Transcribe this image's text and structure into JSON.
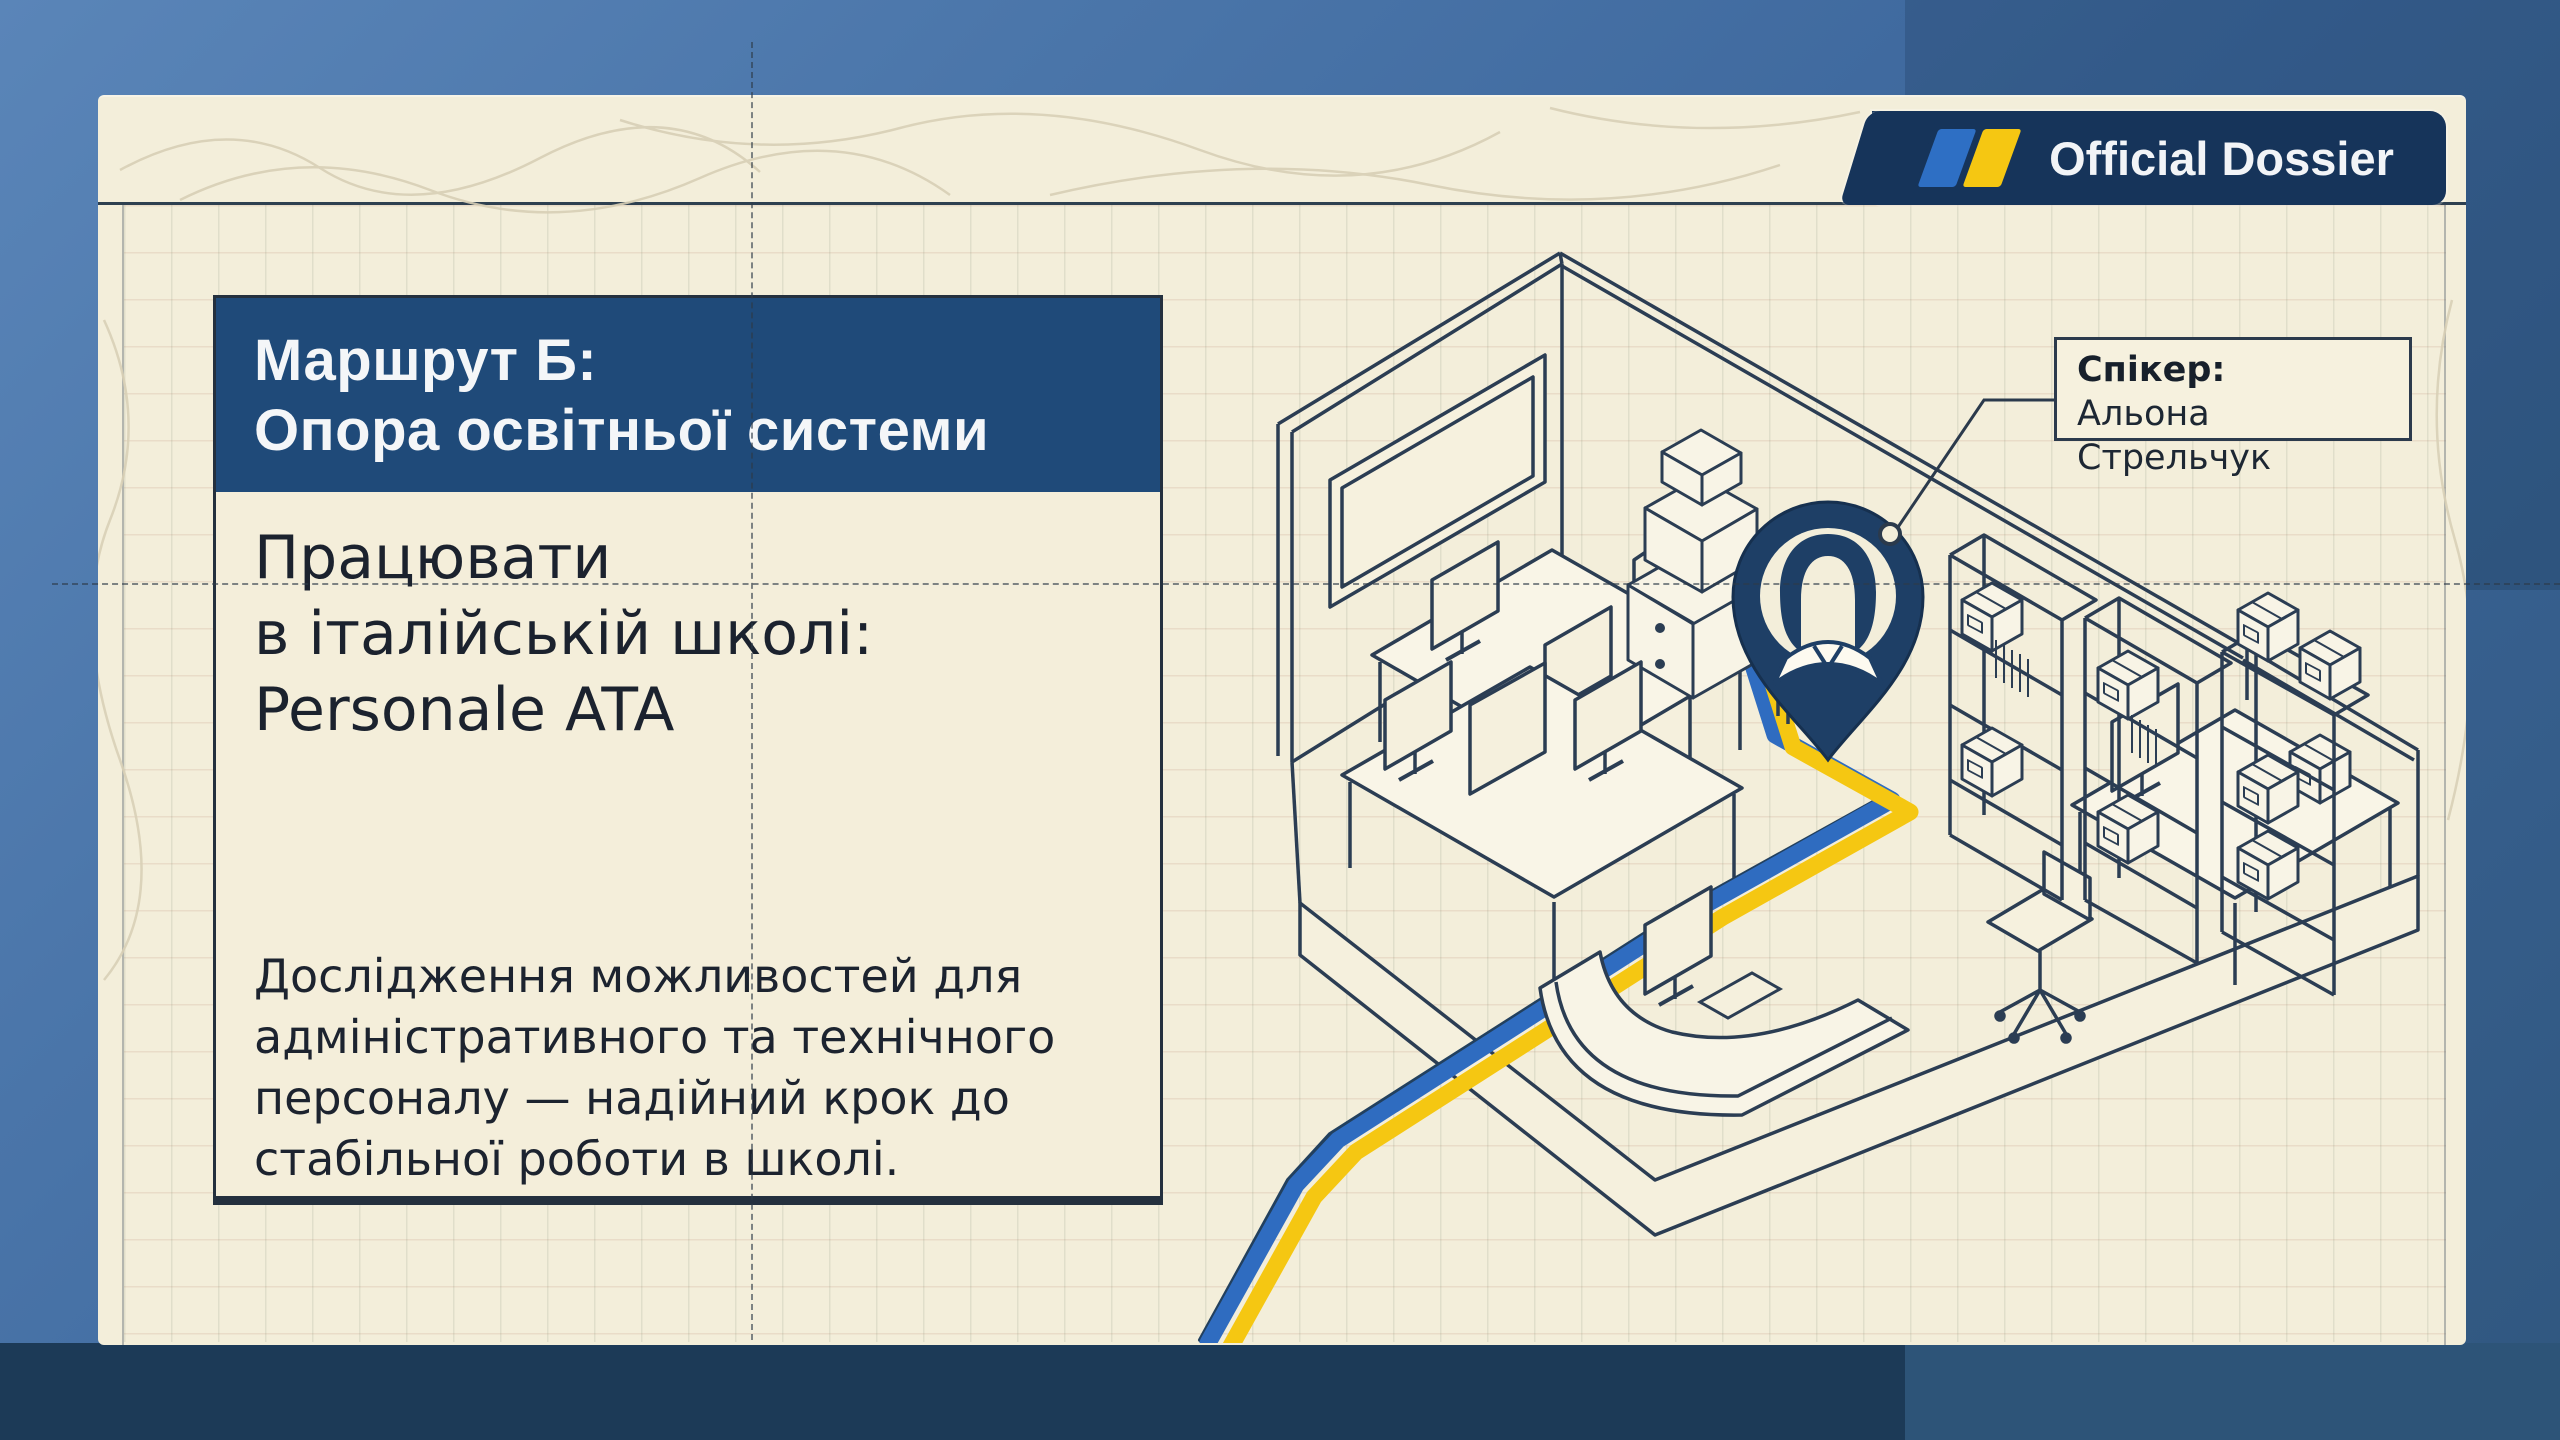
{
  "badge": {
    "label": "Official Dossier",
    "flag_icon": "ukraine-flag-stripes",
    "background": "#16345a",
    "stripe_blue": "#2e6fc4",
    "stripe_yellow": "#f5c712"
  },
  "panel": {
    "title": {
      "line1": "Маршрут Б:",
      "line2": "Опора освітньої системи",
      "background": "#1f4a79"
    },
    "subtitle": {
      "line1": "Працювати",
      "line2": "в італійській школі:",
      "line3": "Personale ATA"
    },
    "body": {
      "line1": "Дослідження можливостей для",
      "line2": "адміністративного та технічного",
      "line3": "персоналу — надійний крок до",
      "line4": "стабільної роботи в школі."
    }
  },
  "callout": {
    "label": "Спікер:",
    "name": "Альона Стрельчук"
  },
  "illustration": {
    "type": "isometric-office-room",
    "elements": [
      "left-wall-whiteboard",
      "open-door",
      "desks-with-monitors",
      "printer-stack",
      "storage-racks-with-boxes",
      "reception-counter",
      "office-chair",
      "location-pin-with-person",
      "blue-yellow-route"
    ],
    "route_blue": "#2f6cc0",
    "route_yellow": "#f5c712",
    "line_color": "#2b3d53",
    "pin_color": "#1e3f66"
  },
  "colors": {
    "paper": "#f3eeda",
    "outer_blue": "#3d679c",
    "footer_dark": "#1c3a57",
    "footer_light": "#2d5478",
    "ink": "#1c232f"
  }
}
